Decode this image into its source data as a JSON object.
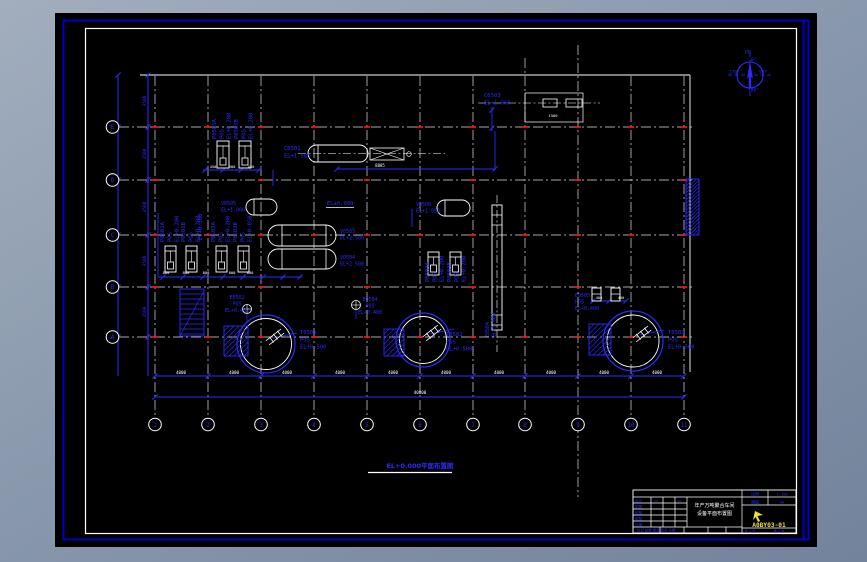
{
  "colors": {
    "desktop": "#8a99ad",
    "canvas": "#000000",
    "frame_blue": "#0000cd",
    "sheet_white": "#ffffff",
    "line_blue": "#2b2bff",
    "dim_white": "#ffffff",
    "tick_red": "#ff1a1a",
    "number_yellow": "#f0dc3c"
  },
  "plan_title": "EL+0.000平面布置图",
  "compass": {
    "pn": "PN",
    "d0": "0°",
    "d90": "90°",
    "d180": "180°",
    "d270": "270°"
  },
  "grid": {
    "row_bubbles": [
      "E",
      "D",
      "C",
      "B",
      "A"
    ],
    "col_bubbles": [
      "1",
      "2",
      "3",
      "4",
      "5",
      "6",
      "7",
      "8",
      "9",
      "10",
      "11"
    ]
  },
  "title_block": {
    "title_line1": "年产万吨聚合车间",
    "title_line2": "设备平面布置图",
    "scale_label": "比例",
    "scale_value": "1:100",
    "format_label": "图幅",
    "format_value": "A0",
    "drawing_number": "A0BY03-01",
    "sheets_total": "共 1 张",
    "sheet_number": "第 1 张",
    "strip": "标记 处数 更改 签名 日期"
  },
  "annotations": [
    {
      "n": "pump-p0505a-label",
      "x": 216,
      "y": 139,
      "r": -90,
      "t": [
        "P0505A",
        "POS",
        "EL+0.200"
      ]
    },
    {
      "n": "pump-p0505b-label",
      "x": 238,
      "y": 139,
      "r": -90,
      "t": [
        "P0505B",
        "POS",
        "EL+0.200"
      ]
    },
    {
      "n": "pump-p0501a-label",
      "x": 164,
      "y": 242,
      "r": -90,
      "t": [
        "P0501A",
        "POS",
        "EL+0.200"
      ]
    },
    {
      "n": "pump-p0501b-label",
      "x": 185,
      "y": 242,
      "r": -90,
      "t": [
        "P0501B",
        "POS",
        "EL+0.200"
      ]
    },
    {
      "n": "el-0300-label",
      "x": 202,
      "y": 240,
      "r": -90,
      "t": [
        "EL+0.300"
      ]
    },
    {
      "n": "pump-p0502a-label",
      "x": 215,
      "y": 242,
      "r": -90,
      "t": [
        "P0502A",
        "POS",
        "EL+0.200"
      ]
    },
    {
      "n": "pump-p0502b-label",
      "x": 237,
      "y": 242,
      "r": -90,
      "t": [
        "P0502B",
        "POS",
        "EL+0.050"
      ]
    },
    {
      "n": "pump-p0503a-label",
      "x": 429,
      "y": 282,
      "r": -90,
      "t": [
        "P0503A",
        "POS",
        "EL+0.200"
      ]
    },
    {
      "n": "pump-p0503b-label",
      "x": 451,
      "y": 282,
      "r": -90,
      "t": [
        "P0503B",
        "POS",
        "EL+0.200"
      ]
    },
    {
      "n": "pump-e0505-label",
      "x": 575,
      "y": 297,
      "s": 5,
      "t": [
        "E0505",
        "POS",
        "EL+0.400"
      ]
    },
    {
      "n": "inst-e0502-label",
      "x": 237,
      "y": 299,
      "a": "middle",
      "s": 5,
      "t": [
        "E0502",
        "POS",
        "EL+0.400"
      ]
    },
    {
      "n": "inst-e0504-label",
      "x": 370,
      "y": 301,
      "a": "middle",
      "s": 5,
      "t": [
        "E0504",
        "POS",
        "EL+0.400"
      ]
    },
    {
      "n": "tank-t0501-label",
      "x": 300,
      "y": 334,
      "t": [
        "T0501",
        "POS",
        "EL+0.500"
      ]
    },
    {
      "n": "tank-t0502-label",
      "x": 446,
      "y": 336,
      "t": [
        "T0502",
        "POS",
        "EL+0.500"
      ]
    },
    {
      "n": "tank-t0503-label",
      "x": 668,
      "y": 334,
      "t": [
        "T0503",
        "POS",
        "EL+0.500"
      ]
    },
    {
      "n": "vessel-c0501-label",
      "x": 284,
      "y": 150,
      "t": [
        "C0501",
        "EL+1.500"
      ]
    },
    {
      "n": "vessel-c0503-label",
      "x": 484,
      "y": 97,
      "t": [
        "C0503",
        "EL+1.000"
      ]
    },
    {
      "n": "vessel-v0505-label",
      "x": 221,
      "y": 205,
      "s": 5,
      "t": [
        "V0505",
        "EL+1.000"
      ]
    },
    {
      "n": "vessel-v0503-label",
      "x": 340,
      "y": 233,
      "s": 5,
      "t": [
        "V0503",
        "EL+2.500"
      ]
    },
    {
      "n": "vessel-v0504-label",
      "x": 340,
      "y": 259,
      "s": 5,
      "t": [
        "V0504",
        "EL+2.500"
      ]
    },
    {
      "n": "vessel-v0508-label",
      "x": 416,
      "y": 206,
      "s": 5,
      "t": [
        "V0508",
        "EL+1.050"
      ]
    },
    {
      "n": "el-0000-label",
      "x": 327,
      "y": 205,
      "t": [
        "EL±0.000"
      ]
    },
    {
      "n": "vessel-e0504-tall-label",
      "x": 489,
      "y": 337,
      "r": -90,
      "s": 5,
      "t": [
        "E0504",
        "EL+1.000"
      ]
    },
    {
      "n": "dim-3500-1",
      "x": 146,
      "y": 101,
      "r": -90,
      "a": "middle",
      "s": 4.5,
      "t": [
        "3500"
      ]
    },
    {
      "n": "dim-3500-2",
      "x": 146,
      "y": 154,
      "r": -90,
      "a": "middle",
      "s": 4.5,
      "t": [
        "3500"
      ]
    },
    {
      "n": "dim-3500-3",
      "x": 146,
      "y": 207,
      "r": -90,
      "a": "middle",
      "s": 4.5,
      "t": [
        "3500"
      ]
    },
    {
      "n": "dim-3500-4",
      "x": 146,
      "y": 261,
      "r": -90,
      "a": "middle",
      "s": 4.5,
      "t": [
        "3500"
      ]
    },
    {
      "n": "dim-3500-5",
      "x": 146,
      "y": 312,
      "r": -90,
      "a": "middle",
      "s": 4.5,
      "t": [
        "3500"
      ]
    },
    {
      "n": "dim-4000-1",
      "x": 181,
      "y": 374,
      "a": "middle",
      "s": 4.2,
      "c": "#ffffff",
      "t": [
        "4000"
      ]
    },
    {
      "n": "dim-4000-2",
      "x": 234,
      "y": 374,
      "a": "middle",
      "s": 4.2,
      "c": "#ffffff",
      "t": [
        "4000"
      ]
    },
    {
      "n": "dim-4000-3",
      "x": 287,
      "y": 374,
      "a": "middle",
      "s": 4.2,
      "c": "#ffffff",
      "t": [
        "4000"
      ]
    },
    {
      "n": "dim-4000-4",
      "x": 340,
      "y": 374,
      "a": "middle",
      "s": 4.2,
      "c": "#ffffff",
      "t": [
        "4000"
      ]
    },
    {
      "n": "dim-4000-5",
      "x": 393,
      "y": 374,
      "a": "middle",
      "s": 4.2,
      "c": "#ffffff",
      "t": [
        "4000"
      ]
    },
    {
      "n": "dim-4000-6",
      "x": 446,
      "y": 374,
      "a": "middle",
      "s": 4.2,
      "c": "#ffffff",
      "t": [
        "4000"
      ]
    },
    {
      "n": "dim-4000-7",
      "x": 499,
      "y": 374,
      "a": "middle",
      "s": 4.2,
      "c": "#ffffff",
      "t": [
        "4000"
      ]
    },
    {
      "n": "dim-4000-8",
      "x": 551,
      "y": 374,
      "a": "middle",
      "s": 4.2,
      "c": "#ffffff",
      "t": [
        "4000"
      ]
    },
    {
      "n": "dim-4000-9",
      "x": 604,
      "y": 374,
      "a": "middle",
      "s": 4.2,
      "c": "#ffffff",
      "t": [
        "4000"
      ]
    },
    {
      "n": "dim-4000-10",
      "x": 657,
      "y": 374,
      "a": "middle",
      "s": 4.2,
      "c": "#ffffff",
      "t": [
        "4000"
      ]
    },
    {
      "n": "dim-total",
      "x": 420,
      "y": 394,
      "a": "middle",
      "s": 4.2,
      "c": "#ffffff",
      "t": [
        "40000"
      ]
    },
    {
      "n": "dim-8885",
      "x": 380,
      "y": 167,
      "a": "middle",
      "s": 4,
      "c": "#ffffff",
      "t": [
        "8885"
      ]
    },
    {
      "n": "dim-450a",
      "x": 213,
      "y": 168,
      "a": "middle",
      "s": 3.8,
      "c": "#ffffff",
      "t": [
        "450"
      ]
    },
    {
      "n": "dim-900",
      "x": 232,
      "y": 168,
      "a": "middle",
      "s": 3.8,
      "c": "#ffffff",
      "t": [
        "900"
      ]
    },
    {
      "n": "dim-450b",
      "x": 251,
      "y": 168,
      "a": "middle",
      "s": 3.8,
      "c": "#ffffff",
      "t": [
        "450"
      ]
    },
    {
      "n": "dim-800-1",
      "x": 166,
      "y": 274,
      "a": "middle",
      "s": 3.8,
      "c": "#ffffff",
      "t": [
        "800"
      ]
    },
    {
      "n": "dim-800-2",
      "x": 186,
      "y": 274,
      "a": "middle",
      "s": 3.8,
      "c": "#ffffff",
      "t": [
        "800"
      ]
    },
    {
      "n": "dim-800-3",
      "x": 206,
      "y": 274,
      "a": "middle",
      "s": 3.8,
      "c": "#ffffff",
      "t": [
        "800"
      ]
    },
    {
      "n": "dim-800-4",
      "x": 232,
      "y": 274,
      "a": "middle",
      "s": 3.8,
      "c": "#ffffff",
      "t": [
        "800"
      ]
    },
    {
      "n": "dim-800-5",
      "x": 250,
      "y": 274,
      "a": "middle",
      "s": 3.8,
      "c": "#ffffff",
      "t": [
        "800"
      ]
    },
    {
      "n": "dim-400a",
      "x": 599,
      "y": 299,
      "a": "middle",
      "s": 3.6,
      "c": "#ffffff",
      "t": [
        "400"
      ]
    },
    {
      "n": "dim-400b",
      "x": 621,
      "y": 299,
      "a": "middle",
      "s": 3.6,
      "c": "#ffffff",
      "t": [
        "400"
      ]
    },
    {
      "n": "dim-1500",
      "x": 553,
      "y": 117,
      "a": "middle",
      "s": 3.8,
      "c": "#ffffff",
      "t": [
        "1500"
      ]
    },
    {
      "n": "tb-row-design",
      "x": 635,
      "y": 502,
      "s": 3.6,
      "t": [
        "设计"
      ]
    },
    {
      "n": "tb-row-draft",
      "x": 635,
      "y": 508,
      "s": 3.6,
      "t": [
        "制图"
      ]
    },
    {
      "n": "tb-row-check",
      "x": 635,
      "y": 514,
      "s": 3.6,
      "t": [
        "校核"
      ]
    },
    {
      "n": "tb-row-audit",
      "x": 635,
      "y": 520,
      "s": 3.6,
      "t": [
        "审核"
      ]
    },
    {
      "n": "tb-row-date",
      "x": 635,
      "y": 526,
      "s": 3.6,
      "t": [
        "日期"
      ]
    },
    {
      "n": "tb-sig1",
      "x": 654,
      "y": 502,
      "s": 3.6,
      "t": [
        "××"
      ]
    },
    {
      "n": "tb-sig2",
      "x": 677,
      "y": 502,
      "s": 3.6,
      "t": [
        "××"
      ]
    }
  ]
}
